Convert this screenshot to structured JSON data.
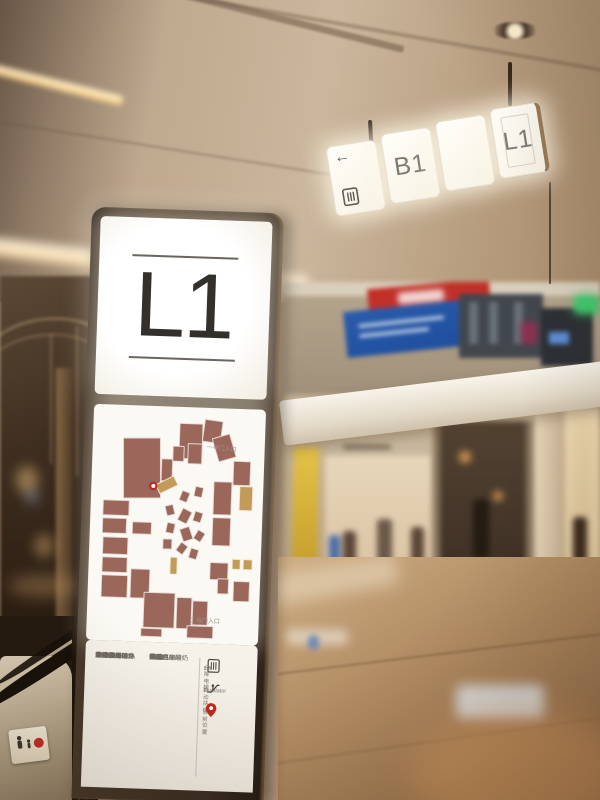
{
  "hanging_sign": {
    "panels": [
      {
        "name": "direction",
        "arrow": "←",
        "label": ""
      },
      {
        "name": "b1",
        "label": "B1"
      },
      {
        "name": "blank",
        "label": ""
      },
      {
        "name": "l1",
        "label": "L1"
      }
    ]
  },
  "totem": {
    "floor": "L1",
    "map": {
      "gate_top": "一号门入口",
      "gate_bottom": "二号门入口",
      "colors": {
        "unit": "#9b675a",
        "accent": "#c49a58",
        "path": "#faf8f1"
      },
      "pin": {
        "x": 34,
        "y": 32
      },
      "blocks": [
        {
          "x": 15,
          "y": 12,
          "w": 24,
          "h": 27,
          "r": -2
        },
        {
          "x": 39,
          "y": 21,
          "w": 8,
          "h": 10,
          "r": 0
        },
        {
          "x": 50,
          "y": 5,
          "w": 15,
          "h": 16,
          "r": 0
        },
        {
          "x": 65,
          "y": 3,
          "w": 12,
          "h": 10,
          "r": 6
        },
        {
          "x": 56,
          "y": 14,
          "w": 9,
          "h": 9,
          "r": 0
        },
        {
          "x": 46,
          "y": 15,
          "w": 8,
          "h": 7,
          "r": 0
        },
        {
          "x": 73,
          "y": 10,
          "w": 12,
          "h": 11,
          "r": -18
        },
        {
          "x": 85,
          "y": 21,
          "w": 11,
          "h": 11,
          "r": 0
        },
        {
          "x": 89,
          "y": 32,
          "w": 9,
          "h": 11,
          "r": 0,
          "t": 1
        },
        {
          "x": 73,
          "y": 30,
          "w": 12,
          "h": 15,
          "r": 0
        },
        {
          "x": 73,
          "y": 46,
          "w": 12,
          "h": 13,
          "r": 0
        },
        {
          "x": 37,
          "y": 30,
          "w": 13,
          "h": 5,
          "r": -28,
          "t": 1
        },
        {
          "x": 3,
          "y": 40,
          "w": 17,
          "h": 7,
          "r": 0
        },
        {
          "x": 3,
          "y": 48,
          "w": 16,
          "h": 7,
          "r": 0
        },
        {
          "x": 4,
          "y": 56,
          "w": 16,
          "h": 8,
          "r": 0
        },
        {
          "x": 4,
          "y": 65,
          "w": 16,
          "h": 7,
          "r": 0
        },
        {
          "x": 4,
          "y": 73,
          "w": 17,
          "h": 10,
          "r": 0
        },
        {
          "x": 22,
          "y": 49,
          "w": 13,
          "h": 6,
          "r": 0
        },
        {
          "x": 22,
          "y": 70,
          "w": 13,
          "h": 13,
          "r": 0
        },
        {
          "x": 52,
          "y": 35,
          "w": 6,
          "h": 5,
          "r": 20
        },
        {
          "x": 61,
          "y": 33,
          "w": 6,
          "h": 5,
          "r": 10
        },
        {
          "x": 43,
          "y": 41,
          "w": 6,
          "h": 5,
          "r": -15
        },
        {
          "x": 52,
          "y": 43,
          "w": 7,
          "h": 6,
          "r": 25
        },
        {
          "x": 61,
          "y": 44,
          "w": 6,
          "h": 5,
          "r": 15
        },
        {
          "x": 44,
          "y": 49,
          "w": 6,
          "h": 5,
          "r": 10
        },
        {
          "x": 53,
          "y": 51,
          "w": 7,
          "h": 6,
          "r": -20
        },
        {
          "x": 62,
          "y": 52,
          "w": 6,
          "h": 5,
          "r": 30
        },
        {
          "x": 42,
          "y": 56,
          "w": 6,
          "h": 5,
          "r": 0
        },
        {
          "x": 51,
          "y": 58,
          "w": 6,
          "h": 5,
          "r": 35
        },
        {
          "x": 59,
          "y": 60,
          "w": 6,
          "h": 5,
          "r": 15
        },
        {
          "x": 47,
          "y": 64,
          "w": 5,
          "h": 8,
          "r": 0,
          "t": 1
        },
        {
          "x": 72,
          "y": 66,
          "w": 12,
          "h": 8,
          "r": 0
        },
        {
          "x": 86,
          "y": 64,
          "w": 6,
          "h": 5,
          "r": 0,
          "t": 1
        },
        {
          "x": 93,
          "y": 64,
          "w": 6,
          "h": 5,
          "r": 0,
          "t": 1
        },
        {
          "x": 77,
          "y": 73,
          "w": 8,
          "h": 7,
          "r": 0
        },
        {
          "x": 87,
          "y": 74,
          "w": 11,
          "h": 9,
          "r": 0
        },
        {
          "x": 31,
          "y": 80,
          "w": 20,
          "h": 16,
          "r": 0
        },
        {
          "x": 52,
          "y": 82,
          "w": 10,
          "h": 14,
          "r": 0
        },
        {
          "x": 62,
          "y": 83,
          "w": 10,
          "h": 11,
          "r": 0
        },
        {
          "x": 59,
          "y": 94,
          "w": 17,
          "h": 6,
          "r": 0
        },
        {
          "x": 30,
          "y": 96,
          "w": 14,
          "h": 4,
          "r": 0
        }
      ]
    },
    "directory": {
      "columns": [
        {
          "entries": [
            [
              "L101",
              "太平洋咖啡"
            ],
            [
              "L103",
              "世为国际健身"
            ],
            [
              "L107",
              "PATAVINITY"
            ],
            [
              "L108",
              "NOME"
            ],
            [
              "L110",
              "最初的面包坊"
            ],
            [
              "L111",
              "上果"
            ],
            [
              "L112",
              "SEVEN BUS"
            ],
            [
              "L113",
              "WL"
            ],
            [
              "L114",
              "瑞幸咖啡"
            ],
            [
              "L116",
              "GLORIA"
            ],
            [
              "L117",
              "金羽佳"
            ],
            [
              "L118",
              "芙丝小铺"
            ],
            [
              "L123",
              "星光侠"
            ],
            [
              "L125",
              "S-DEER"
            ],
            [
              "L127",
              "VERO MODA"
            ]
          ]
        },
        {
          "entries": [
            [
              "L131",
              "INXL"
            ],
            [
              "L135",
              "YO!"
            ],
            [
              "L136",
              "UNA"
            ],
            [
              "L137",
              "loumolan"
            ],
            [
              "L139",
              "OMI"
            ],
            [
              "L141",
              "乐芙"
            ],
            [
              "L149",
              "丝芙兰"
            ],
            [
              "L150",
              "榴莲"
            ],
            [
              "L152",
              "星巴克咖啡"
            ],
            [
              "L153",
              "1513"
            ],
            [
              "L160",
              "西藏热牛酸奶"
            ],
            [
              "L164",
              "良品"
            ],
            [
              "L166",
              "U9"
            ],
            [
              "L167",
              "酒翁"
            ],
            [
              "L168",
              "恋群"
            ],
            [
              "L170",
              "周黑"
            ]
          ]
        }
      ],
      "legend": [
        {
          "icon": "lift-icon",
          "line1": "Lift",
          "line2": "升降电梯"
        },
        {
          "icon": "escalator-icon",
          "line1": "Escalator",
          "line2": "自动扶梯"
        },
        {
          "icon": "location-pin-icon",
          "line1": "",
          "line2": "当前位置"
        }
      ]
    }
  },
  "colors": {
    "pin_red": "#c0281e",
    "sign_white": "#fdfbf4",
    "frame_bronze": "#3c2f23"
  }
}
